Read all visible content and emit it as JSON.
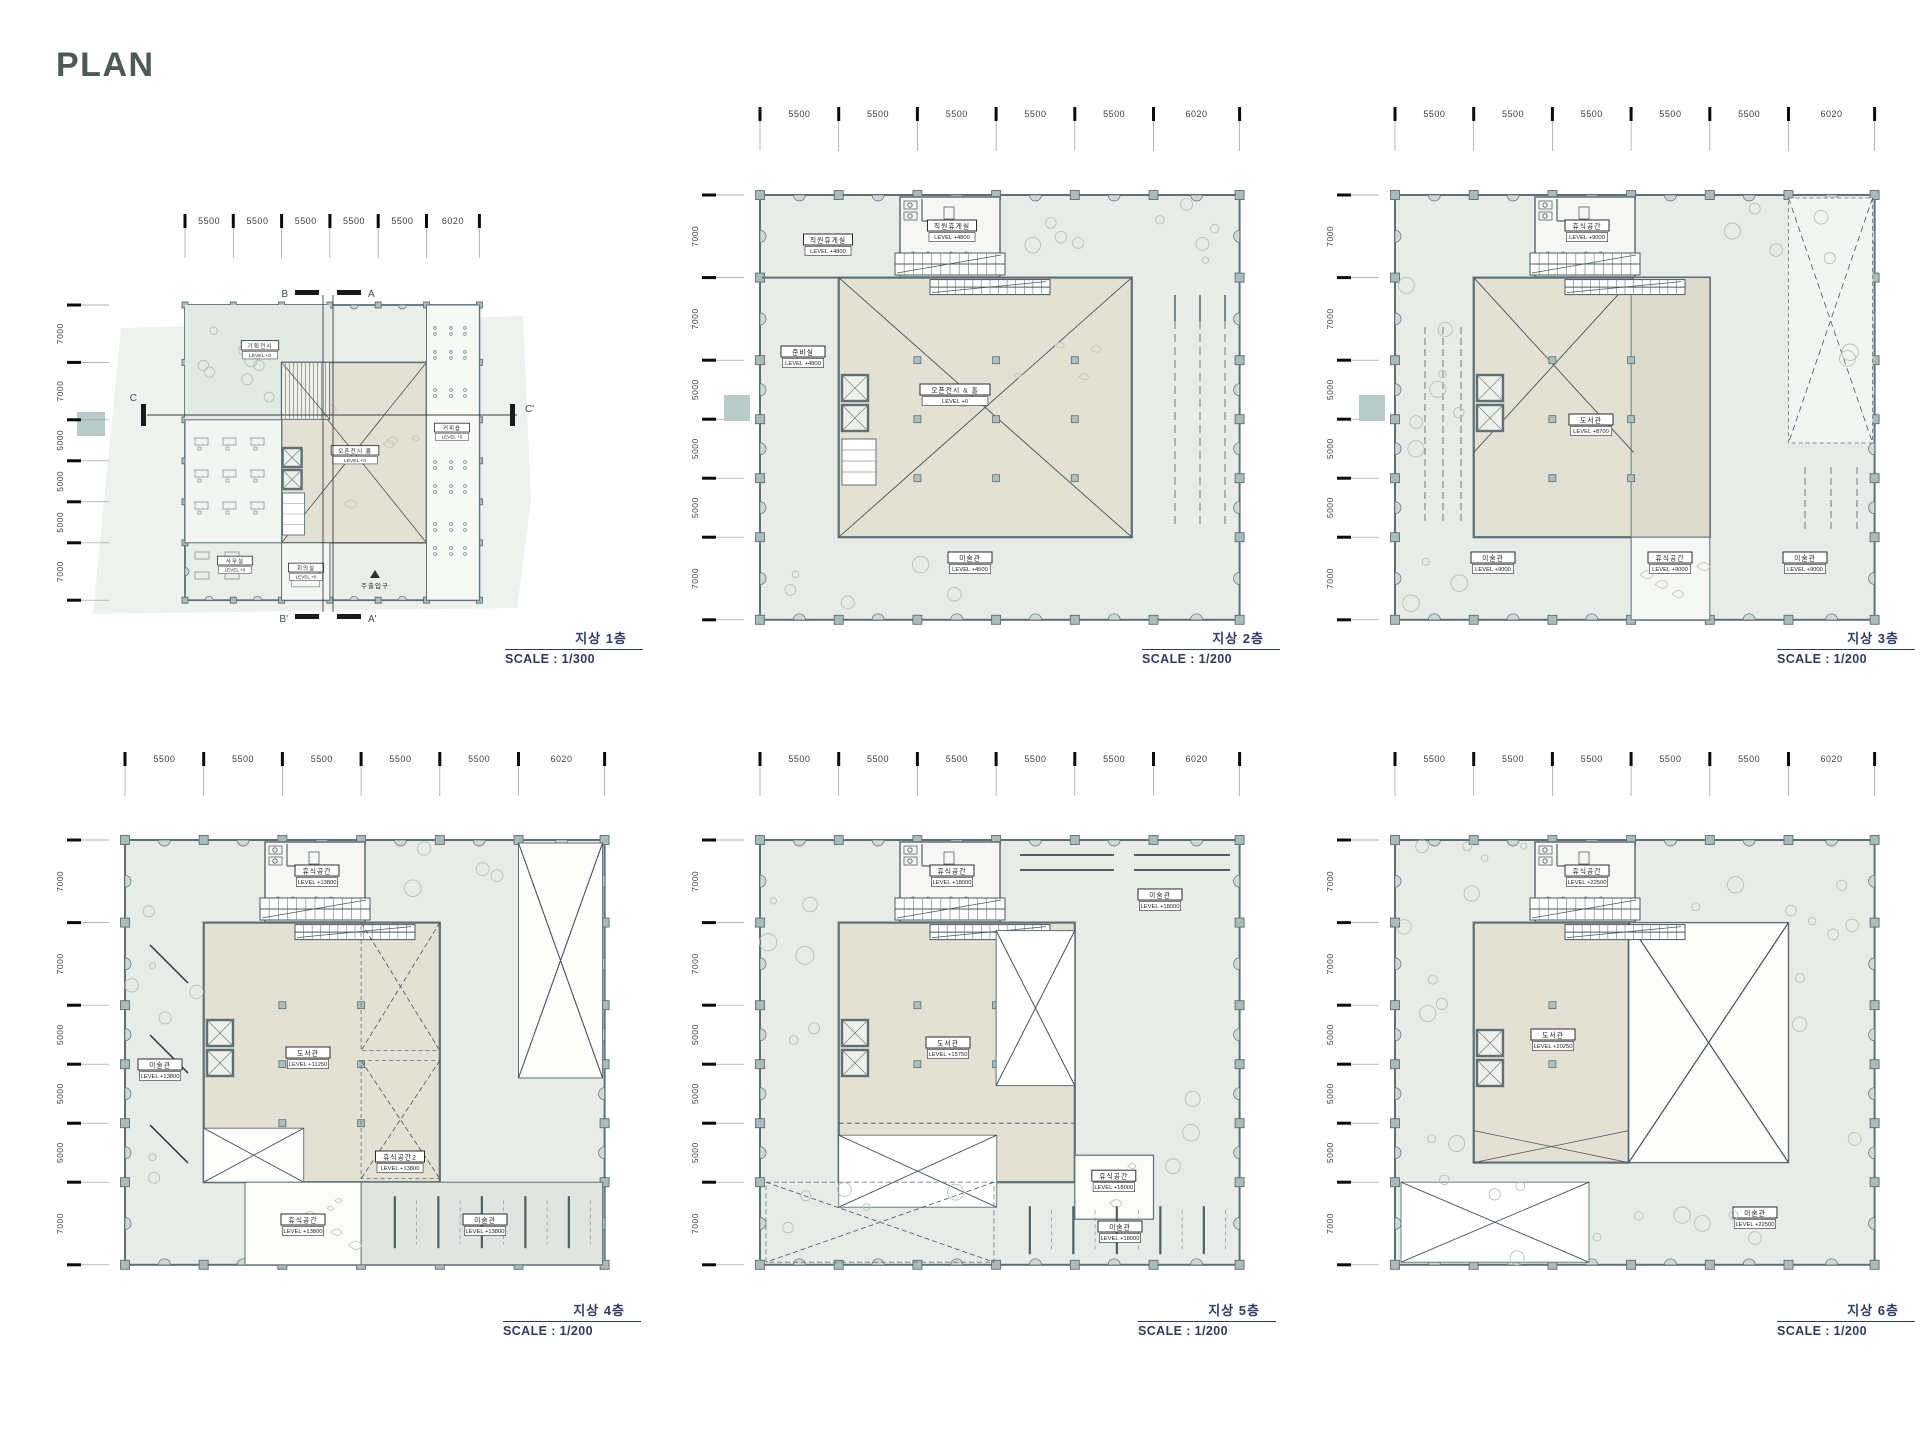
{
  "sheet": {
    "title": "PLAN"
  },
  "colors": {
    "caption_navy": "#2e3b63",
    "title_ink": "#4b5a58",
    "terrace_fill": "#e7ece8",
    "room_beige": "#e2e1d3",
    "room_beige_dark": "#dcdbcc",
    "wall_ink": "#5f6f74",
    "column_fill": "#a9bcba",
    "teal_patch": "#b9cbc9",
    "tree_stroke": "#b7c2ba"
  },
  "plans": [
    {
      "id": "1f",
      "caption_title": "지상 1층",
      "caption_scale": "SCALE : 1/300",
      "dims_top": [
        "5500",
        "5500",
        "5500",
        "5500",
        "5500",
        "6020"
      ],
      "dims_left": [
        "7000",
        "7000",
        "5000",
        "5000",
        "5000",
        "7000"
      ],
      "section_markers": [
        "B",
        "A",
        "C",
        "C'",
        "B'",
        "A'"
      ],
      "rooms": [
        {
          "name": "기획전시",
          "level": "LEVEL +0"
        },
        {
          "name": "오픈전시 홀",
          "level": "LEVEL +0"
        },
        {
          "name": "커피숍",
          "level": "LEVEL +0"
        },
        {
          "name": "사무실",
          "level": "LEVEL +0"
        },
        {
          "name": "회의실",
          "level": "LEVEL +0"
        },
        {
          "name": "주출입구",
          "level": ""
        }
      ]
    },
    {
      "id": "2f",
      "caption_title": "지상 2층",
      "caption_scale": "SCALE : 1/200",
      "dims_top": [
        "5500",
        "5500",
        "5500",
        "5500",
        "5500",
        "6020"
      ],
      "dims_left": [
        "7000",
        "7000",
        "5000",
        "5000",
        "5000",
        "7000"
      ],
      "rooms": [
        {
          "name": "직원휴게실",
          "level": "LEVEL +4800"
        },
        {
          "name": "휴게공간",
          "level": "LEVEL +4800"
        },
        {
          "name": "준비실",
          "level": "LEVEL +4800"
        },
        {
          "name": "오픈전시 & 홀",
          "level": "LEVEL +0"
        },
        {
          "name": "미술관",
          "level": "LEVEL +4500"
        }
      ]
    },
    {
      "id": "3f",
      "caption_title": "지상 3층",
      "caption_scale": "SCALE : 1/200",
      "dims_top": [
        "5500",
        "5500",
        "5500",
        "5500",
        "5500",
        "6020"
      ],
      "dims_left": [
        "7000",
        "7000",
        "5000",
        "5000",
        "5000",
        "7000"
      ],
      "rooms": [
        {
          "name": "휴식공간",
          "level": "LEVEL +9000"
        },
        {
          "name": "도서관",
          "level": "LEVEL +8700"
        },
        {
          "name": "미술관",
          "level": "LEVEL +9000"
        },
        {
          "name": "휴식공간",
          "level": "LEVEL +9000"
        },
        {
          "name": "미술관",
          "level": "LEVEL +9000"
        }
      ]
    },
    {
      "id": "4f",
      "caption_title": "지상 4층",
      "caption_scale": "SCALE : 1/200",
      "dims_top": [
        "5500",
        "5500",
        "5500",
        "5500",
        "5500",
        "6020"
      ],
      "dims_left": [
        "7000",
        "7000",
        "5000",
        "5000",
        "5000",
        "7000"
      ],
      "rooms": [
        {
          "name": "휴식공간",
          "level": "LEVEL +13800"
        },
        {
          "name": "미술관",
          "level": "LEVEL +13800"
        },
        {
          "name": "도서관",
          "level": "LEVEL +11250"
        },
        {
          "name": "휴식공간2",
          "level": "LEVEL +13800"
        },
        {
          "name": "휴식공간",
          "level": "LEVEL +13800"
        },
        {
          "name": "미술관",
          "level": "LEVEL +13800"
        }
      ]
    },
    {
      "id": "5f",
      "caption_title": "지상 5층",
      "caption_scale": "SCALE : 1/200",
      "dims_top": [
        "5500",
        "5500",
        "5500",
        "5500",
        "5500",
        "6020"
      ],
      "dims_left": [
        "7000",
        "7000",
        "5000",
        "5000",
        "5000",
        "7000"
      ],
      "rooms": [
        {
          "name": "휴식공간",
          "level": "LEVEL +18000"
        },
        {
          "name": "미술관",
          "level": "LEVEL +18000"
        },
        {
          "name": "도서관",
          "level": "LEVEL +15750"
        },
        {
          "name": "휴식공간",
          "level": "LEVEL +18000"
        },
        {
          "name": "미술관",
          "level": "LEVEL +18000"
        }
      ]
    },
    {
      "id": "6f",
      "caption_title": "지상 6층",
      "caption_scale": "SCALE : 1/200",
      "dims_top": [
        "5500",
        "5500",
        "5500",
        "5500",
        "5500",
        "6020"
      ],
      "dims_left": [
        "7000",
        "7000",
        "5000",
        "5000",
        "5000",
        "7000"
      ],
      "rooms": [
        {
          "name": "휴식공간",
          "level": "LEVEL +22500"
        },
        {
          "name": "도서관",
          "level": "LEVEL +20250"
        },
        {
          "name": "미술관",
          "level": "LEVEL +22500"
        }
      ]
    }
  ]
}
